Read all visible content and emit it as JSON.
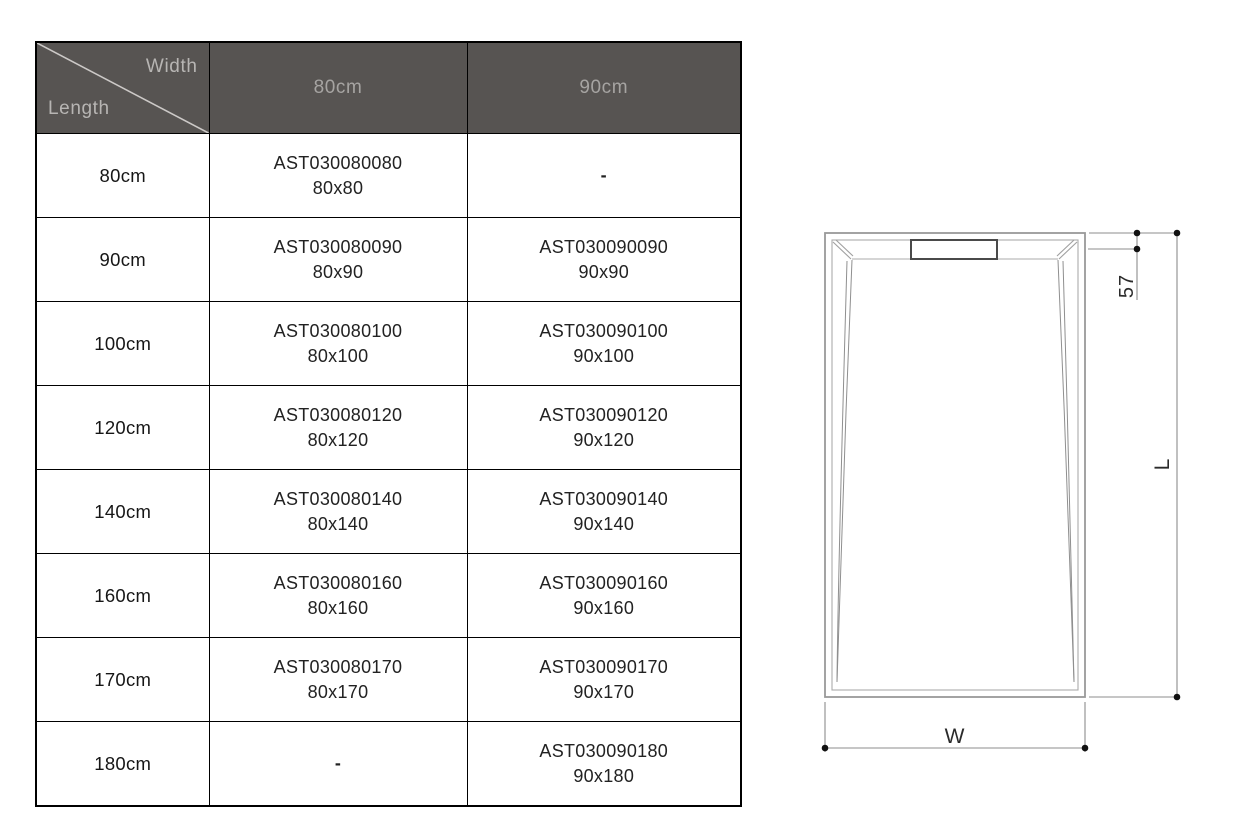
{
  "table": {
    "header": {
      "corner_top": "Width",
      "corner_bottom": "Length",
      "columns": [
        "80cm",
        "90cm"
      ],
      "bg_color": "#575452",
      "label_color": "#b7b5b3",
      "column_color": "#a6a4a2"
    },
    "rows": [
      {
        "length": "80cm",
        "cells": [
          {
            "code": "AST030080080",
            "size": "80x80"
          },
          {
            "code": "-",
            "size": ""
          }
        ]
      },
      {
        "length": "90cm",
        "cells": [
          {
            "code": "AST030080090",
            "size": "80x90"
          },
          {
            "code": "AST030090090",
            "size": "90x90"
          }
        ]
      },
      {
        "length": "100cm",
        "cells": [
          {
            "code": "AST030080100",
            "size": "80x100"
          },
          {
            "code": "AST030090100",
            "size": "90x100"
          }
        ]
      },
      {
        "length": "120cm",
        "cells": [
          {
            "code": "AST030080120",
            "size": "80x120"
          },
          {
            "code": "AST030090120",
            "size": "90x120"
          }
        ]
      },
      {
        "length": "140cm",
        "cells": [
          {
            "code": "AST030080140",
            "size": "80x140"
          },
          {
            "code": "AST030090140",
            "size": "90x140"
          }
        ]
      },
      {
        "length": "160cm",
        "cells": [
          {
            "code": "AST030080160",
            "size": "80x160"
          },
          {
            "code": "AST030090160",
            "size": "90x160"
          }
        ]
      },
      {
        "length": "170cm",
        "cells": [
          {
            "code": "AST030080170",
            "size": "80x170"
          },
          {
            "code": "AST030090170",
            "size": "90x170"
          }
        ]
      },
      {
        "length": "180cm",
        "cells": [
          {
            "code": "-",
            "size": ""
          },
          {
            "code": "AST030090180",
            "size": "90x180"
          }
        ]
      }
    ],
    "empty_marker": "-"
  },
  "diagram": {
    "type": "technical-drawing",
    "description": "Top view of rectangular shower tray with drain at top and dimension lines",
    "labels": {
      "drain_offset": "57",
      "length": "L",
      "width": "W"
    },
    "line_color": "#9a9a9a",
    "text_color": "#2b2b2b"
  }
}
